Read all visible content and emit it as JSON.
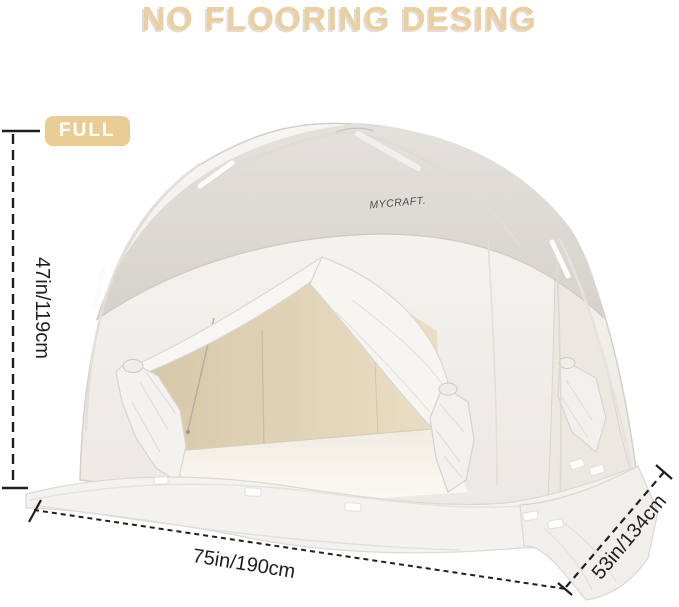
{
  "title": "NO FLOORING DESING",
  "badge": {
    "label": "FULL"
  },
  "tent": {
    "brand": "MYCRAFT."
  },
  "dimensions": {
    "height": "47in/119cm",
    "width": "75in/190cm",
    "depth": "53in/134cm"
  },
  "colors": {
    "title_tan": "#EBCF9C",
    "badge_tan": "#E9CD96",
    "roof_gray": "#D9D6D1",
    "panel_white": "#F3F1EE",
    "interior_beige": "#E3D4B8",
    "annotation_black": "#1f1f1f"
  }
}
